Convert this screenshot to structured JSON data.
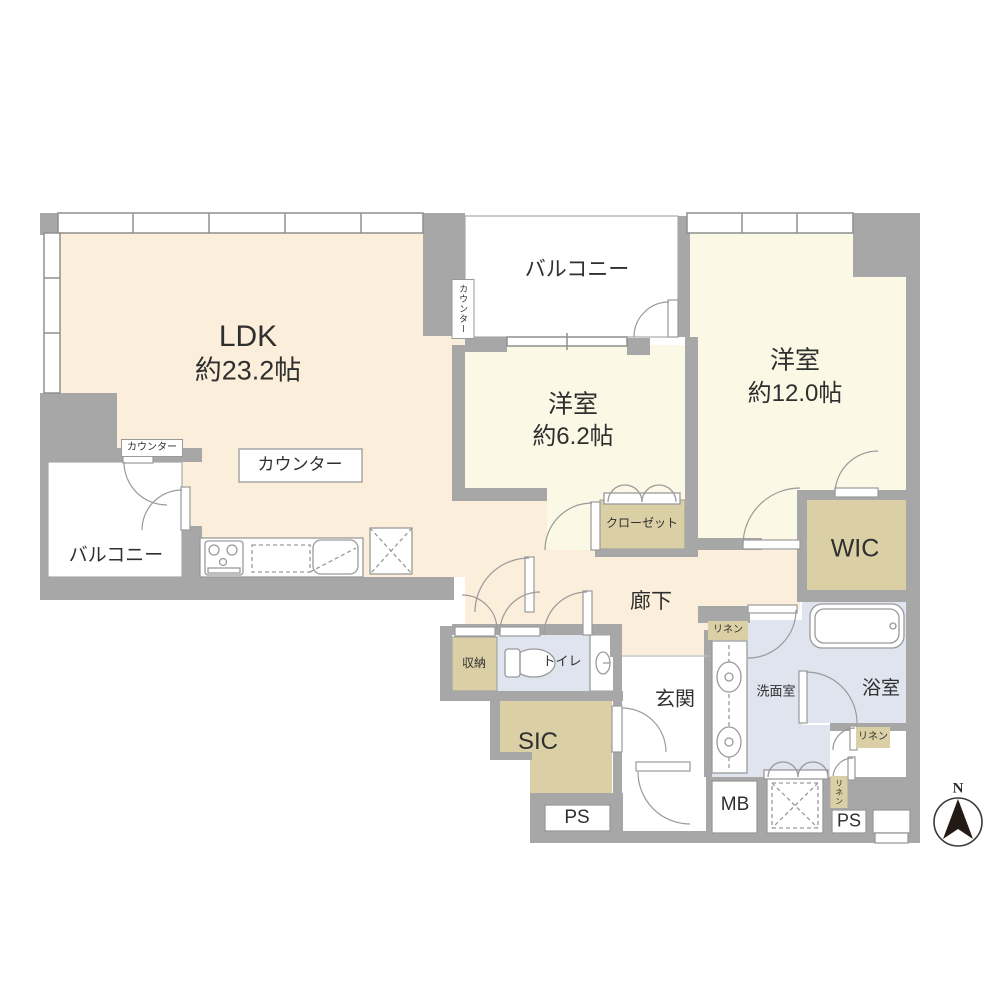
{
  "floorplan": {
    "type": "apartment-floorplan",
    "colors": {
      "wall": "#a7a7a7",
      "ldk_floor": "#fbeeda",
      "bedroom_floor": "#fbf8e5",
      "closet_tan": "#dbcfa5",
      "wet_area_blue": "#dfe4ef",
      "balcony_white": "#ffffff",
      "outline": "#8f8f8f",
      "text": "#2f2f2f"
    },
    "labels": {
      "ldk_name": "LDK",
      "ldk_size": "約23.2帖",
      "bedroom1_name": "洋室",
      "bedroom1_size": "約6.2帖",
      "bedroom2_name": "洋室",
      "bedroom2_size": "約12.0帖",
      "balcony_top": "バルコニー",
      "balcony_left": "バルコニー",
      "counter_box": "カウンター",
      "counter_small": "カウンター",
      "counter_vertical": "カウンター",
      "closet": "クローゼット",
      "wic": "WIC",
      "hallway": "廊下",
      "storage": "収納",
      "toilet": "トイレ",
      "entrance": "玄関",
      "sic": "SIC",
      "washroom": "洗面室",
      "bathroom": "浴室",
      "linen_top": "リネン",
      "linen_bath": "リネン",
      "linen_vertical": "リネン",
      "meter_box": "MB",
      "pipe_space_left": "PS",
      "pipe_space_right": "PS",
      "compass_north": "N"
    }
  }
}
